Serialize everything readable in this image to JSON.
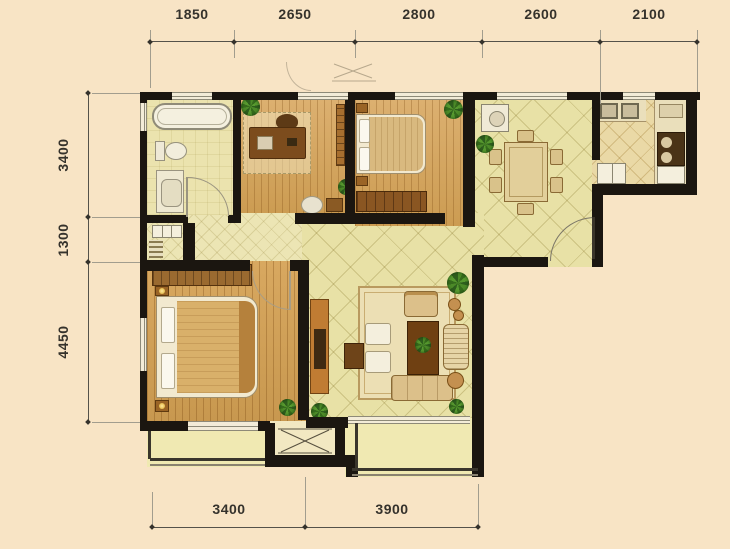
{
  "dims": {
    "top": [
      "1850",
      "2650",
      "2800",
      "2600",
      "2100"
    ],
    "left": [
      "3400",
      "1300",
      "4450"
    ],
    "bottom": [
      "3400",
      "3900"
    ]
  },
  "colors": {
    "background": "#f8e4c5",
    "wall": "#1b1610",
    "wood_floor": "#d6a963",
    "tile_floor": "#e8e1a6",
    "furniture_wood": "#c07c33",
    "plant_green": "#4c8a28",
    "dimension_text": "#35322c"
  }
}
